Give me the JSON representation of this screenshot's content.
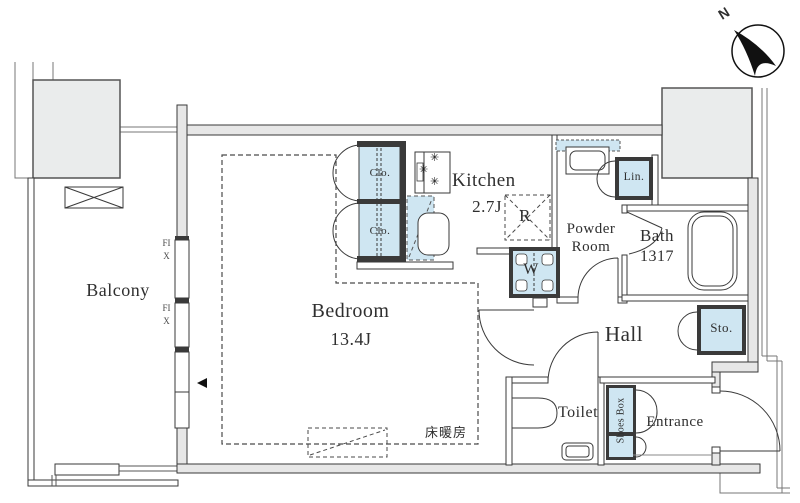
{
  "compass": {
    "label": "N"
  },
  "rooms": {
    "balcony": {
      "label": "Balcony"
    },
    "bedroom": {
      "label": "Bedroom",
      "size": "13.4J"
    },
    "kitchen": {
      "label": "Kitchen",
      "size": "2.7J"
    },
    "powder_room": {
      "label_line1": "Powder",
      "label_line2": "Room"
    },
    "bath": {
      "label": "Bath",
      "size": "1317"
    },
    "hall": {
      "label": "Hall"
    },
    "toilet": {
      "label": "Toilet"
    },
    "entrance": {
      "label": "Entrance"
    }
  },
  "storage": {
    "closet_upper": {
      "label": "Clo."
    },
    "closet_lower": {
      "label": "Clo."
    },
    "linen": {
      "label": "Lin."
    },
    "hall_storage": {
      "label": "Sto."
    },
    "shoes_box": {
      "label": "Shoes Box"
    }
  },
  "appliances": {
    "refrigerator_space": {
      "label": "R"
    },
    "washer_space": {
      "label": "W"
    }
  },
  "windows": {
    "fix_upper": {
      "label": "FIX"
    },
    "fix_lower": {
      "label": "FIX"
    }
  },
  "annotations": {
    "floor_heating": {
      "label": "床暖房"
    }
  },
  "icons": {
    "stove_burner": "✳"
  },
  "colors": {
    "fixture_blue": "#cfe6f2",
    "wall_fill": "#e7e7e7",
    "block_fill": "#eaecec",
    "line": "#3a3a3a"
  }
}
